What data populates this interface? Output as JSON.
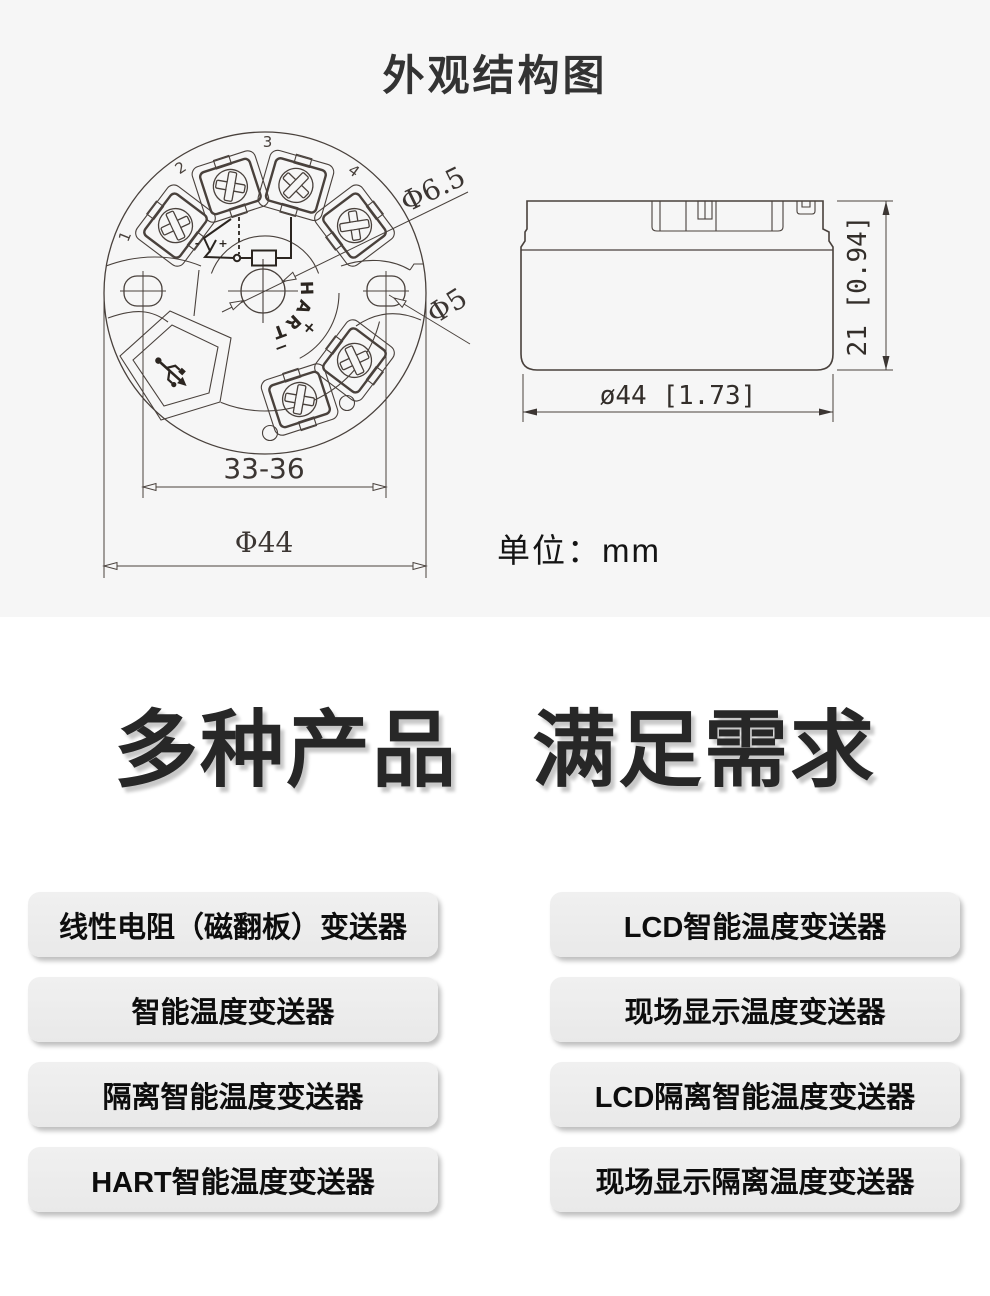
{
  "colors": {
    "section_bg": "#f6f6f6",
    "page_bg": "#ffffff",
    "line": "#49413c",
    "ink": "#2b2520",
    "chip_bg": "#ececec",
    "heading": "#272727"
  },
  "structure": {
    "title": "外观结构图",
    "unit_label": "单位：mm",
    "top_view": {
      "terminal_numbers": [
        "1",
        "2",
        "3",
        "4"
      ],
      "bus_label": "HART",
      "plus": "+",
      "minus": "−",
      "sensor_minus": "-",
      "sensor_plus": "+",
      "dims": {
        "center_hole": "Φ6.5",
        "side_hole": "Φ5",
        "mount_span": "33-36",
        "outer_diameter": "Φ44"
      }
    },
    "side_view": {
      "dims": {
        "width": "ø44 [1.73]",
        "height": "21 [0.94]"
      }
    },
    "icons": {
      "bottom_left_panel": "usb-icon"
    }
  },
  "promo": {
    "heading_left": "多种产品",
    "heading_right": "满足需求",
    "products_left": [
      "线性电阻（磁翻板）变送器",
      "智能温度变送器",
      "隔离智能温度变送器",
      "HART智能温度变送器"
    ],
    "products_right": [
      "LCD智能温度变送器",
      "现场显示温度变送器",
      "LCD隔离智能温度变送器",
      "现场显示隔离温度变送器"
    ]
  }
}
